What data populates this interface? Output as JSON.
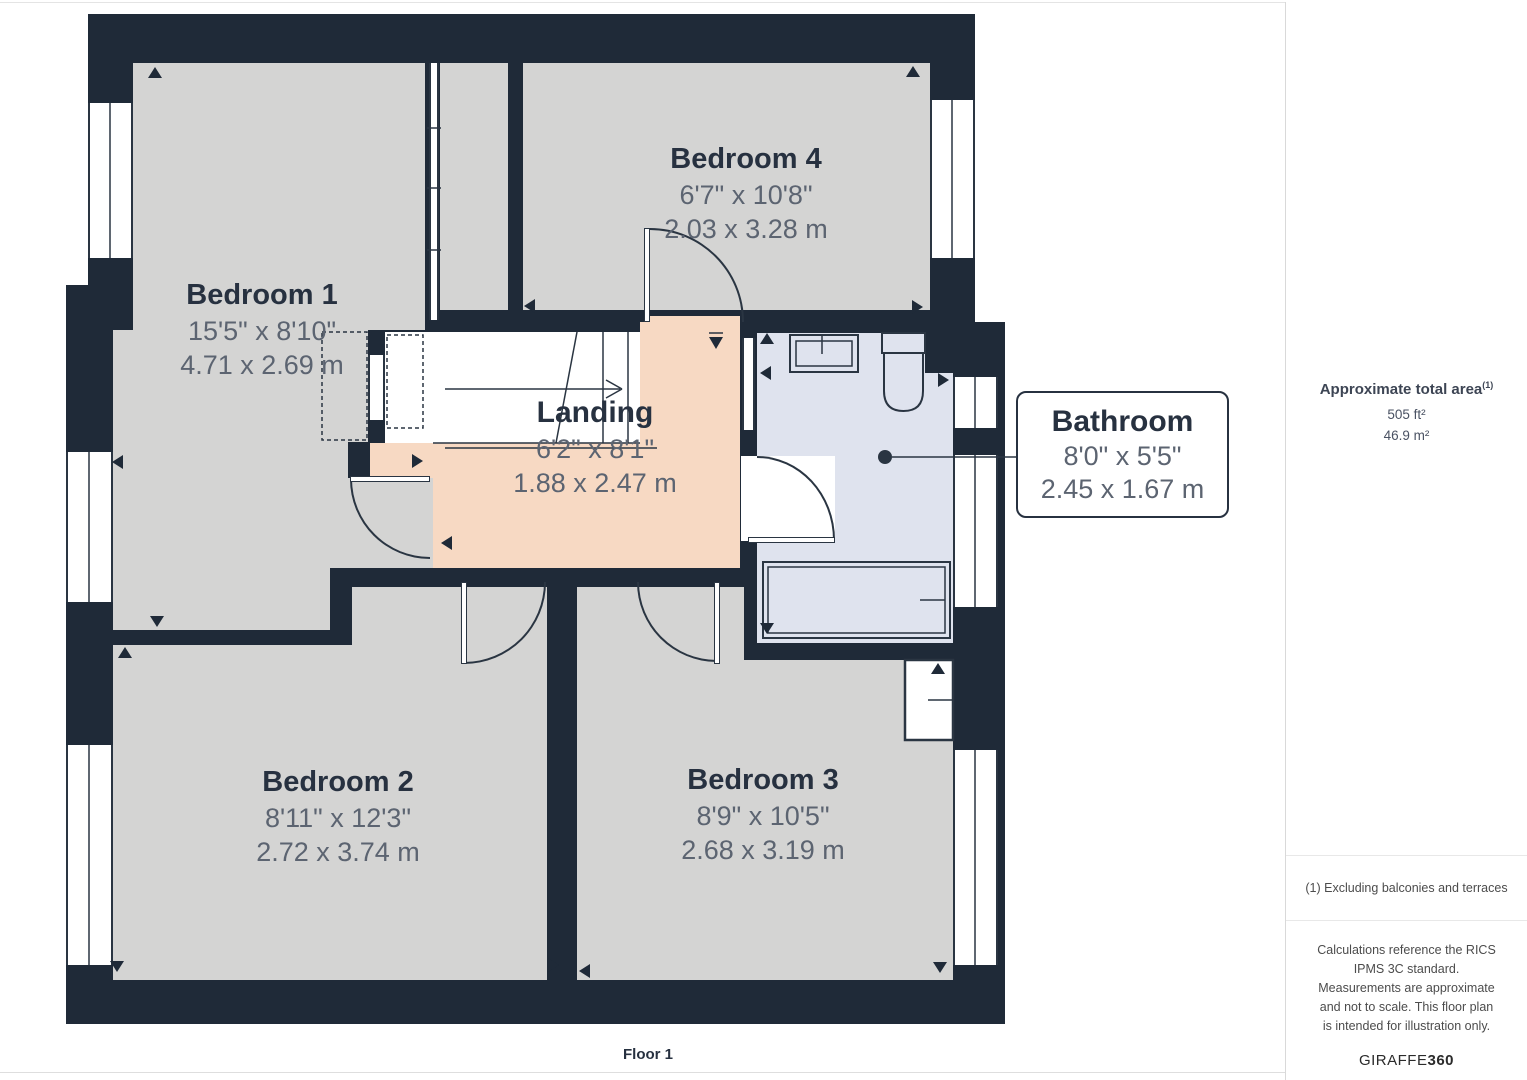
{
  "floor_label": "Floor 1",
  "rooms": {
    "bedroom1": {
      "name": "Bedroom 1",
      "imperial": "15'5\" x 8'10\"",
      "metric": "4.71 x 2.69 m"
    },
    "bedroom2": {
      "name": "Bedroom 2",
      "imperial": "8'11\" x 12'3\"",
      "metric": "2.72 x 3.74 m"
    },
    "bedroom3": {
      "name": "Bedroom 3",
      "imperial": "8'9\" x 10'5\"",
      "metric": "2.68 x 3.19 m"
    },
    "bedroom4": {
      "name": "Bedroom 4",
      "imperial": "6'7\" x 10'8\"",
      "metric": "2.03 x 3.28 m"
    },
    "landing": {
      "name": "Landing",
      "imperial": "6'2\" x 8'1\"",
      "metric": "1.88 x 2.47 m"
    },
    "bathroom": {
      "name": "Bathroom",
      "imperial": "8'0\" x 5'5\"",
      "metric": "2.45 x 1.67 m"
    }
  },
  "sidebar": {
    "area_title": "Approximate total area",
    "area_superscript": "(1)",
    "area_ft": "505 ft²",
    "area_m": "46.9 m²",
    "footnote": "(1) Excluding balconies and terraces",
    "disclaimer": "Calculations reference the RICS IPMS 3C standard. Measurements are approximate and not to scale. This floor plan is intended for illustration only.",
    "brand_prefix": "GIRAFFE",
    "brand_suffix": "360"
  },
  "colors": {
    "wall": "#1f2a38",
    "room": "#d4d4d3",
    "landing": "#f7d9c3",
    "bathroom": "#dfe3ee",
    "accent_text": "#273140",
    "dim_text": "#5c6471"
  }
}
